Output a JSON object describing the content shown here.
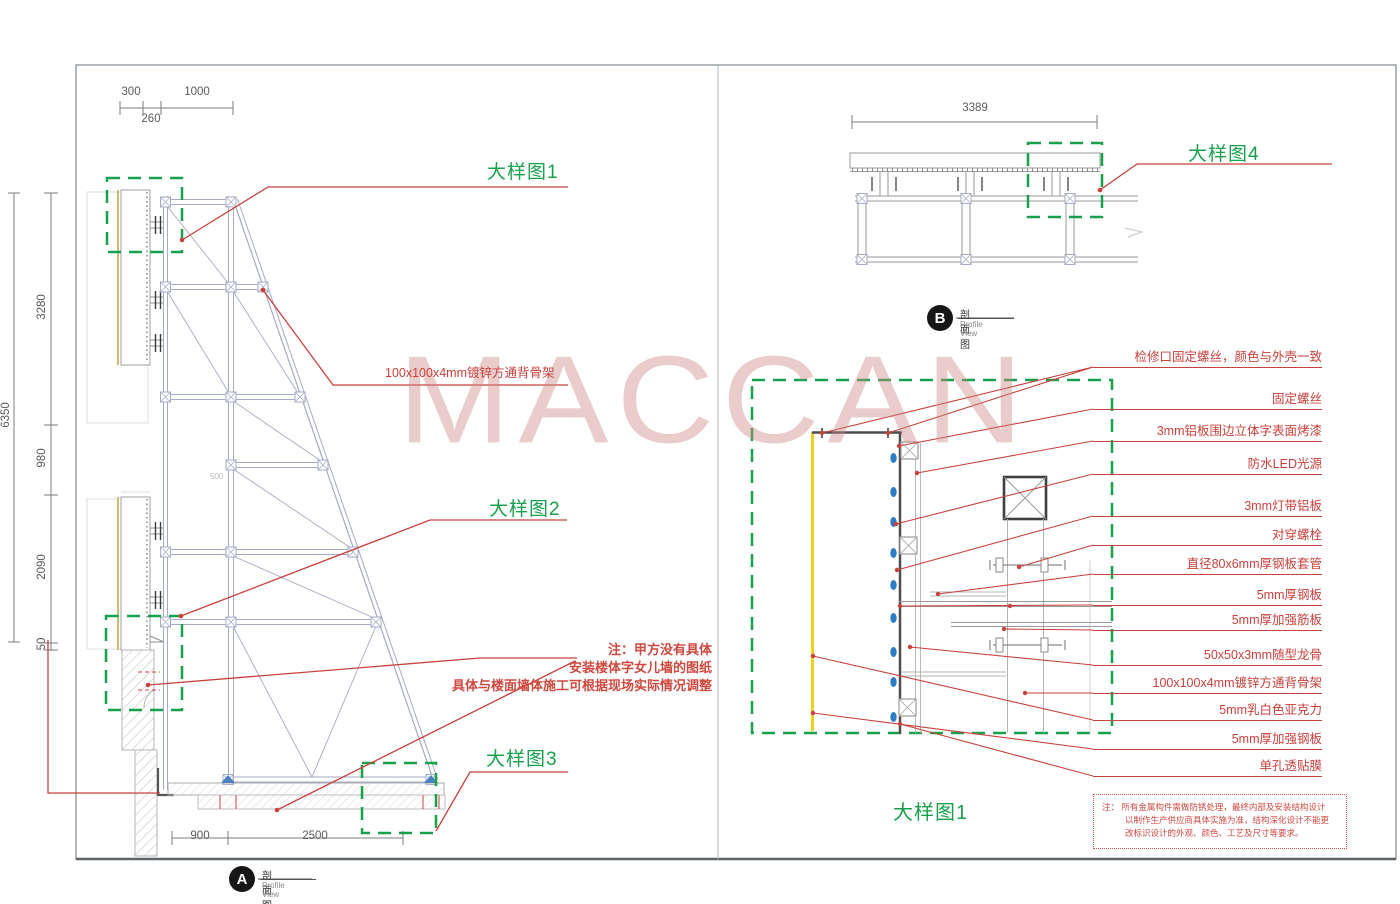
{
  "watermark": "MACCAN",
  "colors": {
    "green": "#17a14d",
    "red": "#c8413c",
    "yellow": "#ecd21c",
    "blue": "#2e7cc3",
    "watermark_pink": "#cd8684"
  },
  "sheet_a": {
    "top_dims": {
      "left": "300",
      "right": "1000",
      "below": "260"
    },
    "left_dims": {
      "total": "6350",
      "segments": [
        "3280",
        "980",
        "2090",
        "50"
      ]
    },
    "panel_dim_small": "500",
    "bottom_dims": {
      "left": "900",
      "right": "2500"
    },
    "details": {
      "d1": "大样图1",
      "d2": "大样图2",
      "d3": "大样图3"
    },
    "callout_backbone": "100x100x4mm镀锌方通背骨架",
    "note_lines": [
      "注：甲方没有具体",
      "安装楼体字女儿墙的图纸",
      "具体与楼面墙体施工可根据现场实际情况调整"
    ],
    "marker": {
      "letter": "A",
      "title_cn": "剖面图",
      "title_en": "Profile View"
    }
  },
  "sheet_b": {
    "top_dim": "3389",
    "detail4": "大样图4",
    "detail1_title": "大样图1",
    "marker": {
      "letter": "B",
      "title_cn": "剖面图",
      "title_en": "Profile View"
    },
    "part_labels": [
      "检修口固定螺丝，颜色与外壳一致",
      "固定螺丝",
      "3mm铝板围边立体字表面烤漆",
      "防水LED光源",
      "3mm灯带铝板",
      "对穿螺栓",
      "直径80x6mm厚钢板套管",
      "5mm厚钢板",
      "5mm厚加强筋板",
      "50x50x3mm随型龙骨",
      "100x100x4mm镀锌方通背骨架",
      "5mm乳白色亚克力",
      "5mm厚加强钢板",
      "单孔透贴膜"
    ],
    "note_box_lines": [
      "注： 所有金属构件需做防锈处理，最终内部及安装结构设计",
      "以制作生产供应商具体实施为准，结构深化设计不能更",
      "改标识设计的外观、颜色、工艺及尺寸等要求。"
    ]
  }
}
